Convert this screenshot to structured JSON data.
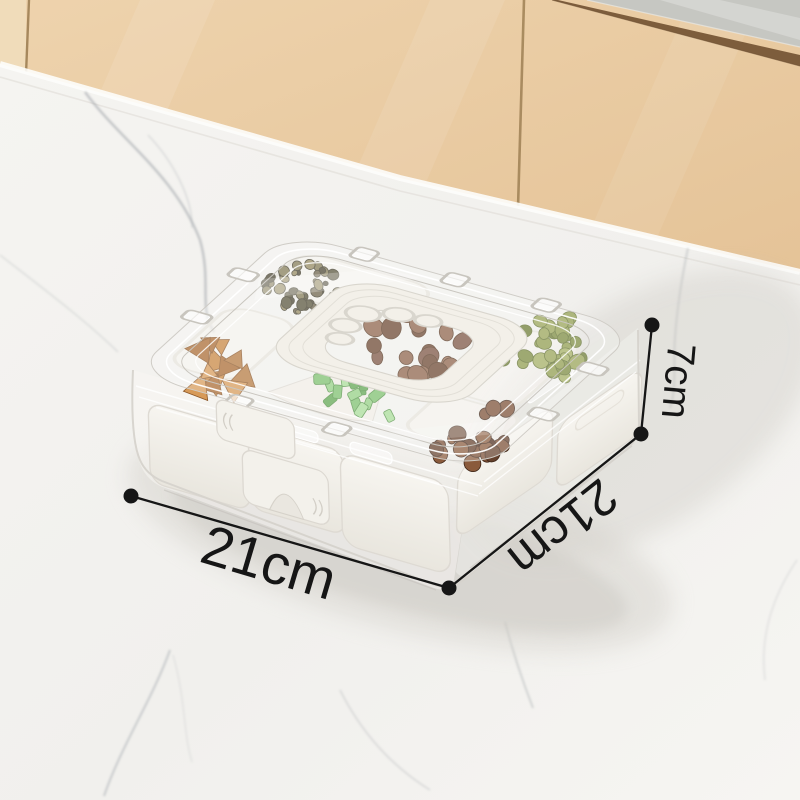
{
  "annotations": {
    "width_label": "21cm",
    "depth_label": "21cm",
    "height_label": "7cm"
  },
  "colors": {
    "annotation": "#161616",
    "cabinet": "#e8c9a2",
    "cabinet_light": "#f0dcba",
    "cabinet_seam": "#9a7c50",
    "cabinet_trim_brown": "#7d5d3c",
    "backsplash_gray": "#c6c7c2",
    "marble": "#f2f1ee",
    "marble_vein": "#9aa0a6",
    "container_white": "#f2f0ea",
    "clear_plastic_edge": "#d6d3cc",
    "food_tea": "#5f5941",
    "food_walnut": "#7b5340",
    "food_green_fig": "#8f9c4d",
    "food_orange": "#c8863f",
    "food_leaf": "#7cbf6d",
    "food_date": "#64402c"
  }
}
